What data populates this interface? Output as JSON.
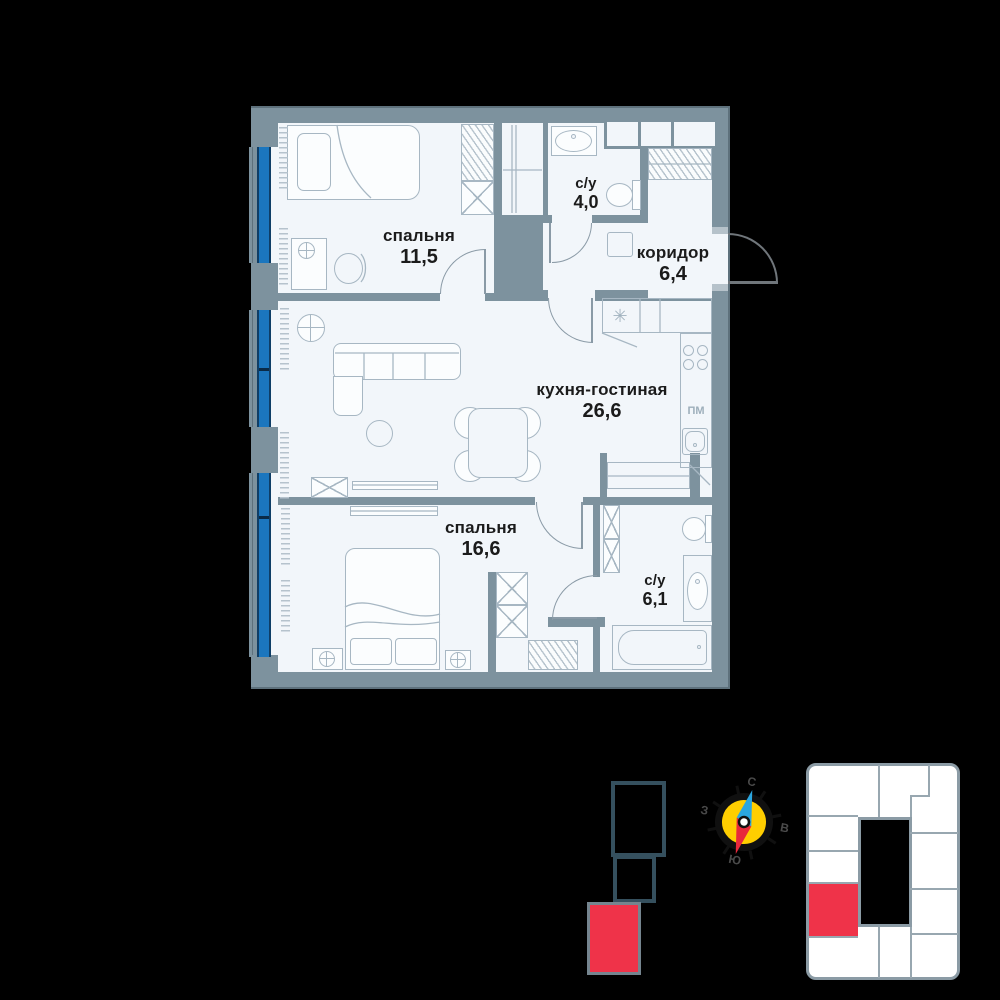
{
  "floor_plan": {
    "rooms": [
      {
        "name": "спальня",
        "area": "11,5"
      },
      {
        "name": "с/у",
        "area": "4,0"
      },
      {
        "name": "коридор",
        "area": "6,4"
      },
      {
        "name": "кухня-гостиная",
        "area": "26,6"
      },
      {
        "name": "спальня",
        "area": "16,6"
      },
      {
        "name": "с/у",
        "area": "6,1"
      }
    ],
    "kitchen_labels": {
      "dishwasher": "ПМ",
      "vent": "✳"
    }
  },
  "compass": {
    "north": "С",
    "east": "В",
    "south": "Ю",
    "west": "З"
  },
  "colors": {
    "background": "#000000",
    "wall": "#7D929E",
    "room_fill": "#F2F6FA",
    "furniture_line": "#A7B7C3",
    "window_glass": "#1B76BE",
    "accent_red": "#EF3349",
    "compass_yellow": "#FFCE00",
    "section_outline": "#35505E"
  }
}
